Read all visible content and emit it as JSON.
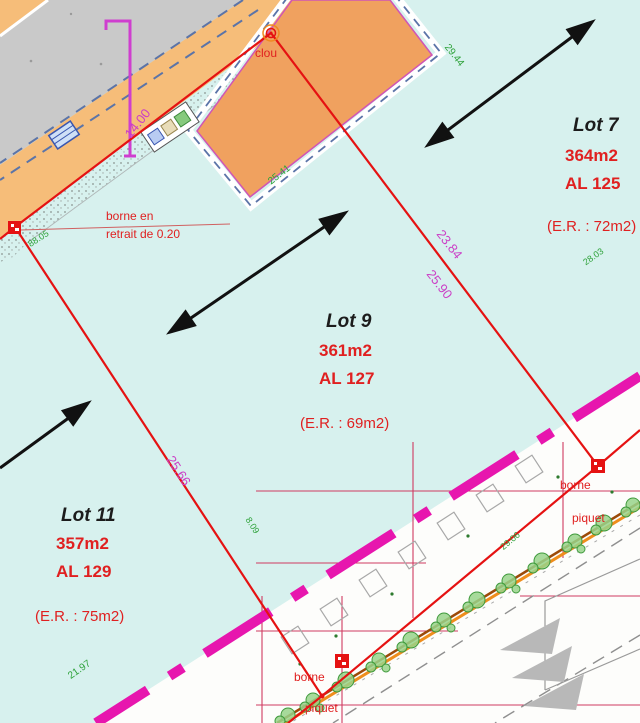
{
  "plan_colors": {
    "background_cyan": "#d7f1ee",
    "road_orange": "#f6bd79",
    "building_orange": "#f0a15f",
    "existing_road_gray": "#c9c9c9",
    "boundary_red": "#e51212",
    "dimension_magenta": "#cb3fc6",
    "survey_green": "#2ea23a",
    "road_limit_magenta": "#e716ae"
  },
  "lots": {
    "lot7": {
      "title": "Lot 7",
      "area": "364m2",
      "al": "AL 125",
      "er": "(E.R. : 72m2)"
    },
    "lot9": {
      "title": "Lot 9",
      "area": "361m2",
      "al": "AL 127",
      "er": "(E.R. : 69m2)"
    },
    "lot11": {
      "title": "Lot 11",
      "area": "357m2",
      "al": "AL 129",
      "er": "(E.R. : 75m2)"
    }
  },
  "markers": {
    "clou": "clou",
    "note_line1": "borne en",
    "note_line2": "retrait de 0.20",
    "borne_top": "borne",
    "piquet_top": "piquet",
    "borne_bottom": "borne",
    "piquet_bottom": "piquet"
  },
  "dimensions": {
    "road_front": "14.00",
    "lot7_side": "23.84",
    "lot9_side": "25.90",
    "lot9_west": "25.66"
  },
  "survey_lengths": {
    "near_borne": "88.05",
    "building_ne": "29.44",
    "building_se": "25.41",
    "lot7_east": "28.03",
    "street_mid": "29.06",
    "lot11_south": "21.97",
    "lot11_east": "8.09"
  }
}
